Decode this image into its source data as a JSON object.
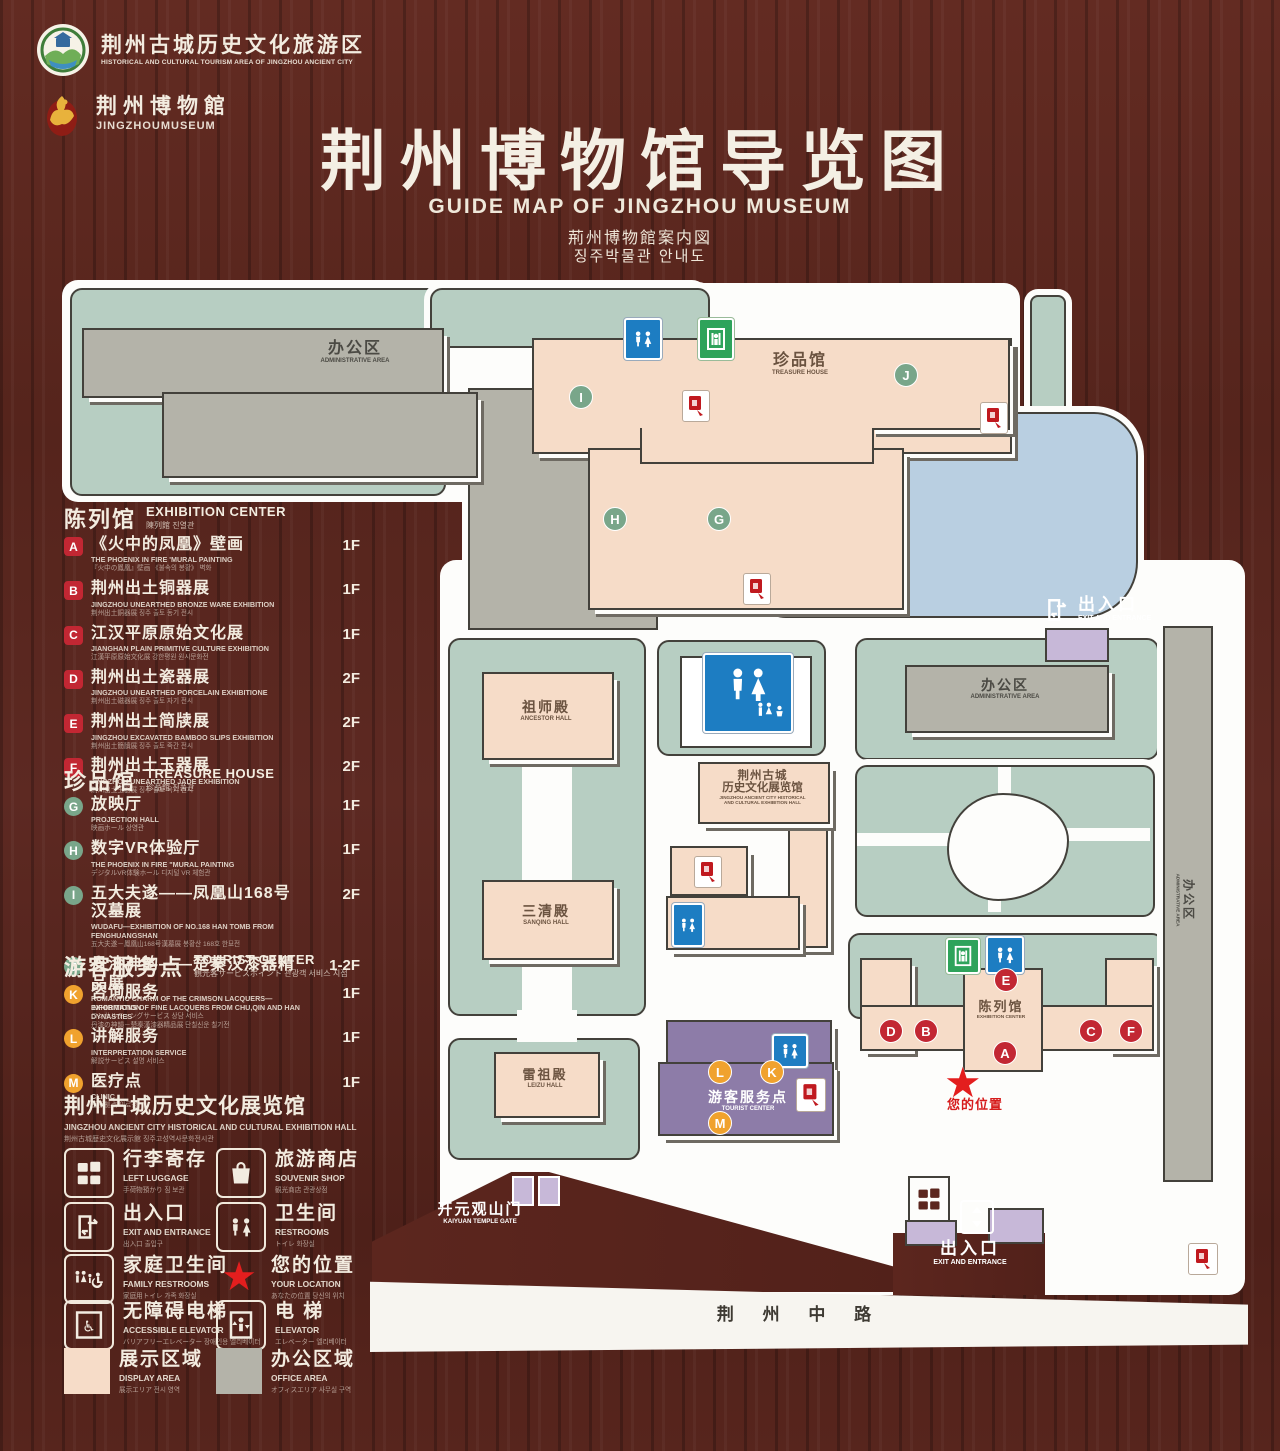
{
  "header": {
    "logo1": {
      "cn": "荆州古城历史文化旅游区",
      "en": "HISTORICAL AND CULTURAL TOURISM AREA OF JINGZHOU ANCIENT CITY"
    },
    "logo2": {
      "cn": "荆州博物館",
      "en": "JINGZHOUMUSEUM"
    },
    "title_cn": "荆州博物馆导览图",
    "title_en": "GUIDE MAP OF JINGZHOU MUSEUM",
    "title_ja": "荊州博物館案内図",
    "title_ko": "징주박물관 안내도"
  },
  "sidebar": {
    "sections": [
      {
        "title_cn": "陈列馆",
        "title_en": "EXHIBITION CENTER",
        "title_sub": "陳列館  진열관",
        "badge_class": "b-red",
        "items": [
          {
            "letter": "A",
            "title": "《火中的凤凰》壁画",
            "en": "THE PHOENIX IN FIRE 'MURAL PAINTING",
            "sub": "『火中の鳳凰』壁画  《불속의 봉황》 벽화",
            "floor": "1F"
          },
          {
            "letter": "B",
            "title": "荆州出土铜器展",
            "en": "JINGZHOU UNEARTHED BRONZE WARE EXHIBITION",
            "sub": "荆州出土銅器展  징주 출토 동기 전시",
            "floor": "1F"
          },
          {
            "letter": "C",
            "title": "江汉平原原始文化展",
            "en": "JIANGHAN PLAIN PRIMITIVE CULTURE EXHIBITION",
            "sub": "江漢平原原始文化展  강한평원 원시문화전",
            "floor": "1F"
          },
          {
            "letter": "D",
            "title": "荆州出土瓷器展",
            "en": "JINGZHOU UNEARTHED PORCELAIN EXHIBITIONE",
            "sub": "荆州出土磁器展  징주 출토 자기 전시",
            "floor": "2F"
          },
          {
            "letter": "E",
            "title": "荆州出土简牍展",
            "en": "JINGZHOU EXCAVATED BAMBOO SLIPS EXHIBITION",
            "sub": "荆州出土簡牘展  징주 출토 죽간 전시",
            "floor": "2F"
          },
          {
            "letter": "F",
            "title": "荆州出土玉器展",
            "en": "JINGZHOU UNEARTHED JADE EXHIBITION",
            "sub": "荆州出土玉器展  징주 출토 옥기 전시",
            "floor": "2F"
          }
        ]
      },
      {
        "title_cn": "珍品馆",
        "title_en": "TREASURE HOUSE",
        "title_sub": "珍品館  진품관",
        "badge_class": "b-green",
        "items": [
          {
            "letter": "G",
            "title": "放映厅",
            "en": "PROJECTION HALL",
            "sub": "映画ホール  상영관",
            "floor": "1F"
          },
          {
            "letter": "H",
            "title": "数字VR体验厅",
            "en": "THE PHOENIX IN FIRE \"MURAL PAINTING",
            "sub": "デジタルVR体験ホール  디지털 VR 체험관",
            "floor": "1F"
          },
          {
            "letter": "I",
            "title": "五大夫遂——凤凰山168号汉墓展",
            "en": "WUDAFU—EXHIBITION OF NO.168 HAN TOMB FROM FENGHUANGSHAN",
            "sub": "五大夫遂－鳳凰山168号漢墓展  봉황산 168호 한묘전",
            "floor": "2F"
          },
          {
            "letter": "J",
            "title": "丹漆神韵——楚秦汉漆器精品展",
            "en": "ROMANTIC CHARM OF THE CRIMSON LACQUERS—EXHIBITIONS OF FINE LACQUERS FROM CHU,QIN AND HAN DYNASTIES",
            "sub": "丹漆の神韻－楚秦漢漆器精品展  단칠신운 칠기전",
            "floor": "1-2F"
          }
        ]
      },
      {
        "title_cn": "游客服务点",
        "title_en": "TOURIST CENTER",
        "title_sub": "観光客サービスポイント  관광객 서비스 지점",
        "badge_class": "b-orange",
        "items": [
          {
            "letter": "K",
            "title": "咨询服务",
            "en": "INFORMATION",
            "sub": "コンサルティングサービス  상담 서비스",
            "floor": "1F"
          },
          {
            "letter": "L",
            "title": "讲解服务",
            "en": "INTERPRETATION SERVICE",
            "sub": "解説サービス  설명 서비스",
            "floor": "1F"
          },
          {
            "letter": "M",
            "title": "医疗点",
            "en": "CLINIC",
            "sub": "医療拠点  의료점",
            "floor": "1F"
          }
        ]
      }
    ],
    "hall_title": {
      "cn": "荆州古城历史文化展览馆",
      "en": "JINGZHOU ANCIENT CITY HISTORICAL AND CULTURAL EXHIBITION HALL",
      "sub": "荆州古城歴史文化展示館  징주고성역사문화전시관"
    },
    "legend": [
      {
        "icon": "left-luggage",
        "cn": "行李寄存",
        "en": "LEFT LUGGAGE",
        "sub": "手荷物預かり  짐 보관"
      },
      {
        "icon": "souvenir-shop",
        "cn": "旅游商店",
        "en": "SOUVENIR SHOP",
        "sub": "観光商店  관광상점"
      },
      {
        "icon": "exit-entrance",
        "cn": "出入口",
        "en": "EXIT AND ENTRANCE",
        "sub": "出入口  출입구"
      },
      {
        "icon": "restrooms",
        "cn": "卫生间",
        "en": "RESTROOMS",
        "sub": "トイレ  화장실"
      },
      {
        "icon": "family-restrooms",
        "cn": "家庭卫生间",
        "en": "FAMILY RESTROOMS",
        "sub": "家庭用トイレ  가족 화장실"
      },
      {
        "icon": "your-location",
        "cn": "您的位置",
        "en": "YOUR LOCATION",
        "sub": "あなたの位置  당신의 위치"
      },
      {
        "icon": "accessible-elevator",
        "cn": "无障碍电梯",
        "en": "ACCESSIBLE ELEVATOR",
        "sub": "バリアフリーエレベーター  장애인용 엘리베이터"
      },
      {
        "icon": "elevator",
        "cn": "电 梯",
        "en": "ELEVATOR",
        "sub": "エレベーター  엘리베이터"
      },
      {
        "icon": "display-area",
        "cn": "展示区域",
        "en": "DISPLAY AREA",
        "sub": "展示エリア  전시 영역"
      },
      {
        "icon": "office-area",
        "cn": "办公区域",
        "en": "OFFICE AREA",
        "sub": "オフィスエリア  사무실 구역"
      }
    ],
    "colors": {
      "display_area": "#f6dcc8",
      "office_area": "#b4b3a9"
    }
  },
  "map": {
    "admin_tl": {
      "cn": "办公区",
      "en": "ADMINISTRATIVE AREA"
    },
    "treasure": {
      "cn": "珍品馆",
      "en": "TREASURE HOUSE"
    },
    "exit_tr": {
      "cn": "出入口",
      "en": "EXIT AND ENTRANCE"
    },
    "admin_r": {
      "cn": "办公区",
      "en": "ADMINISTRATIVE AREA"
    },
    "admin_strip": {
      "cn": "办公区",
      "en": "ADMINISTRATIVE AREA"
    },
    "ancestor_hall": {
      "cn": "祖师殿",
      "en": "ANCESTOR HALL"
    },
    "sanqing_hall": {
      "cn": "三清殿",
      "en": "SANQING HALL"
    },
    "leizu_hall": {
      "cn": "雷祖殿",
      "en": "LEIZU HALL"
    },
    "exhibition_hall_c": {
      "cn1": "荆州古城",
      "cn2": "历史文化展览馆",
      "en1": "JINGZHOU ANCIENT CITY HISTORICAL",
      "en2": "AND CULTURAL EXHIBITION HALL"
    },
    "tourist_center": {
      "cn": "游客服务点",
      "en": "TOURIST CENTER"
    },
    "exhibition_center": {
      "cn": "陈列馆",
      "en": "EXHIBITION CENTER"
    },
    "your_location": {
      "cn": "您的位置"
    },
    "kaiyuan_gate": {
      "cn": "开元观山门",
      "en": "KAIYUAN TEMPLE GATE"
    },
    "exit_b": {
      "cn": "出入口",
      "en": "EXIT AND ENTRANCE"
    },
    "road": {
      "cn": "荆 州 中 路"
    },
    "markers": {
      "a": "A",
      "b": "B",
      "c": "C",
      "d": "D",
      "e": "E",
      "f": "F",
      "g": "G",
      "h": "H",
      "i": "I",
      "j": "J",
      "k": "K",
      "l": "L",
      "m": "M"
    },
    "star_glyph": "★"
  }
}
